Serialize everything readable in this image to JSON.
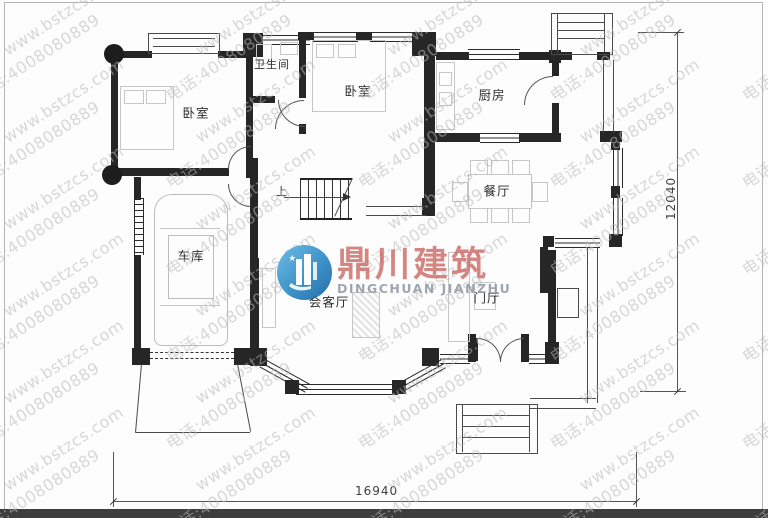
{
  "watermark": {
    "line1": "www.bstzcs.com",
    "line2": "电话:4008080889"
  },
  "logo": {
    "name_cn": "鼎川建筑",
    "name_en": "DINGCHUAN JIANZHU"
  },
  "dimensions": {
    "width_total": "16940",
    "height_total": "12040"
  },
  "rooms": [
    {
      "id": "bedroom-1",
      "label": "卧室"
    },
    {
      "id": "bathroom",
      "label": "卫生间"
    },
    {
      "id": "bedroom-2",
      "label": "卧室"
    },
    {
      "id": "kitchen",
      "label": "厨房"
    },
    {
      "id": "dining-room",
      "label": "餐厅"
    },
    {
      "id": "garage",
      "label": "车库"
    },
    {
      "id": "living-room",
      "label": "会客厅"
    },
    {
      "id": "foyer",
      "label": "门厅"
    }
  ],
  "stairs": {
    "direction_label": "上"
  },
  "colors": {
    "wall": "#262626",
    "logo_blue": "#2d8ac5",
    "logo_red": "#c96a65",
    "logo_gray": "#96a0a9",
    "watermark_gray": "#b9b9b9",
    "bottom_bar": "#3e3e3e"
  }
}
